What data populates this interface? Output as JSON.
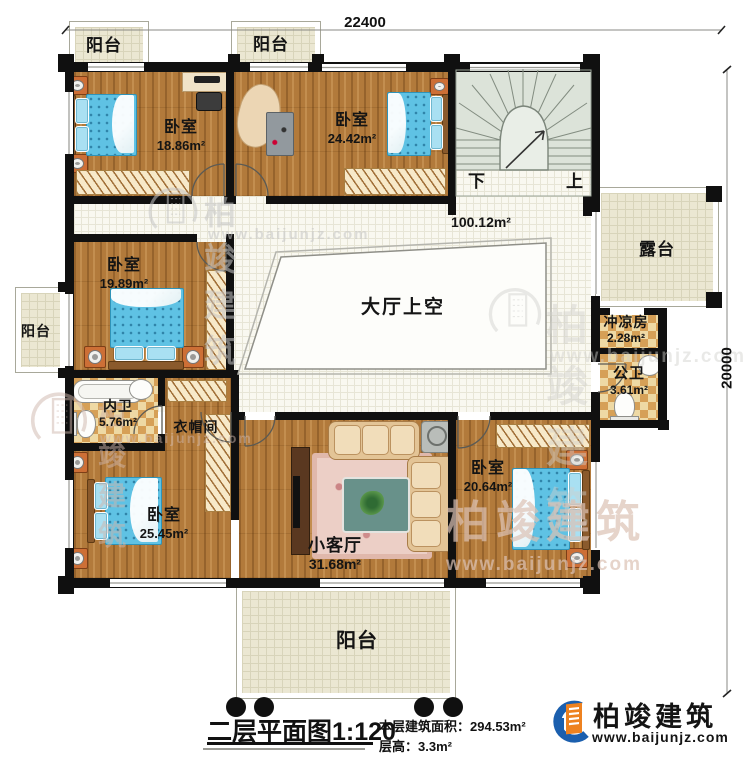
{
  "meta": {
    "dim_top": "22400",
    "dim_right": "20000"
  },
  "title": {
    "main": "二层平面图",
    "scale": "1:120",
    "area_label": "本层建筑面积：",
    "area_value": "294.53m²",
    "height_label": "层高：",
    "height_value": "3.3m²"
  },
  "brand": {
    "name": "柏竣建筑",
    "site": "www.baijunjz.com"
  },
  "rooms": {
    "balcony_top_left": {
      "name": "阳台"
    },
    "balcony_top_mid": {
      "name": "阳台"
    },
    "balcony_left": {
      "name": "阳台"
    },
    "balcony_bottom": {
      "name": "阳台"
    },
    "bedroom_top_left": {
      "name": "卧室",
      "area": "18.86m²"
    },
    "bedroom_top_mid": {
      "name": "卧室",
      "area": "24.42m²"
    },
    "bedroom_mid_left": {
      "name": "卧室",
      "area": "19.89m²"
    },
    "bedroom_bottom_left": {
      "name": "卧室",
      "area": "25.45m²"
    },
    "bedroom_bottom_right": {
      "name": "卧室",
      "area": "20.64m²"
    },
    "living": {
      "name": "小客厅",
      "area": "31.68m²"
    },
    "hall": {
      "area": "100.12m²"
    },
    "hall_void": {
      "name": "大厅上空"
    },
    "terrace": {
      "name": "露台"
    },
    "shower": {
      "name": "冲凉房",
      "area": "2.28m²"
    },
    "public_wc": {
      "name": "公卫",
      "area": "3.61m²"
    },
    "ensuite_wc": {
      "name": "内卫",
      "area": "5.76m²"
    },
    "cloakroom": {
      "name": "衣帽间"
    }
  },
  "stairs": {
    "down": "下",
    "up": "上"
  }
}
